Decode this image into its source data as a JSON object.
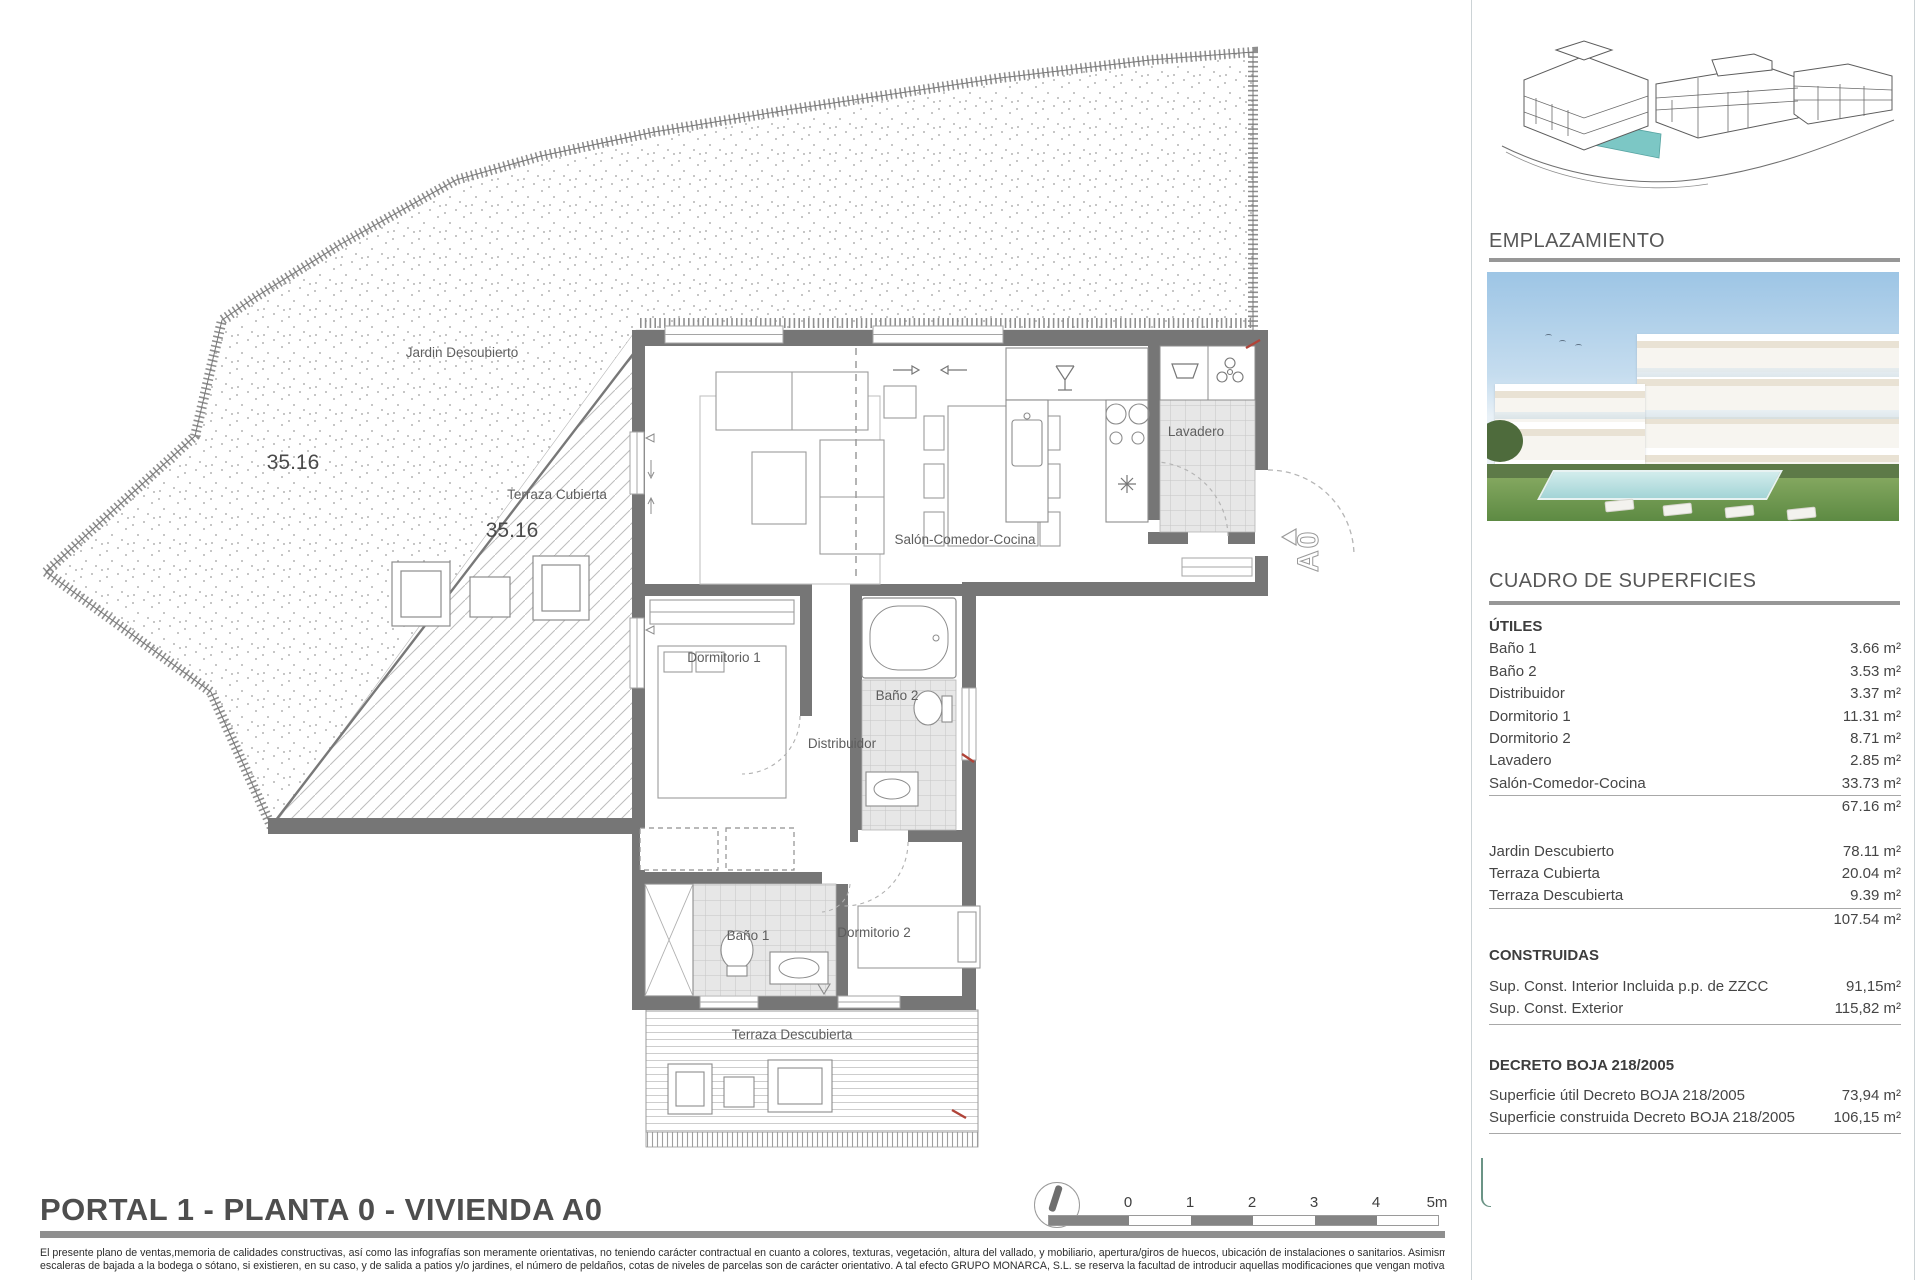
{
  "plan": {
    "title": "PORTAL 1 - PLANTA 0 - VIVIENDA A0",
    "labels": {
      "jardin": "Jardin Descubierto",
      "jardin_area": "35.16",
      "terraza_cubierta": "Terraza Cubierta",
      "terraza_cubierta_area": "35.16",
      "salon": "Salón-Comedor-Cocina",
      "lavadero": "Lavadero",
      "dormitorio1": "Dormitorio 1",
      "dormitorio2": "Dormitorio 2",
      "bano1": "Baño 1",
      "bano2": "Baño 2",
      "distribuidor": "Distribuidor",
      "terraza_descubierta": "Terraza Descubierta",
      "unit": "A0"
    },
    "scale": {
      "ticks": [
        "0",
        "1",
        "2",
        "3",
        "4",
        "5m"
      ]
    },
    "disclaimer": {
      "line1": "El presente plano de ventas,memoria de calidades constructivas, así como las infografías son meramente orientativas, no teniendo carácter contractual en cuanto a colores, texturas, vegetación, altura del vallado, y mobiliario, apertura/giros de huecos, ubicación de instalaciones o sanitarios. Asimismo, en las",
      "line2": "escaleras de bajada a la bodega o sótano, si existieren, en su caso, y de salida a patios y/o jardines, el número de peldaños, cotas de niveles de parcelas son de carácter orientativo. A tal efecto GRUPO MONARCA, S.L.  se reserva la facultad de introducir aquellas modificaciones que vengan motivadas por razones"
    }
  },
  "sidebar": {
    "emplazamiento_title": "EMPLAZAMIENTO",
    "cuadro_title": "CUADRO DE SUPERFICIES",
    "utiles": {
      "heading": "ÚTILES",
      "rows": [
        {
          "label": "Baño 1",
          "value": "3.66 m²"
        },
        {
          "label": "Baño 2",
          "value": "3.53 m²"
        },
        {
          "label": "Distribuidor",
          "value": "3.37 m²"
        },
        {
          "label": "Dormitorio 1",
          "value": "11.31 m²"
        },
        {
          "label": "Dormitorio 2",
          "value": "8.71 m²"
        },
        {
          "label": "Lavadero",
          "value": "2.85 m²"
        },
        {
          "label": "Salón-Comedor-Cocina",
          "value": "33.73 m²"
        }
      ],
      "total": "67.16 m²"
    },
    "exterior": {
      "rows": [
        {
          "label": "Jardin Descubierto",
          "value": "78.11 m²"
        },
        {
          "label": "Terraza Cubierta",
          "value": "20.04 m²"
        },
        {
          "label": "Terraza Descubierta",
          "value": "9.39 m²"
        }
      ],
      "total": "107.54 m²"
    },
    "construidas": {
      "heading": "CONSTRUIDAS",
      "rows": [
        {
          "label": "Sup. Const. Interior Incluida p.p. de ZZCC",
          "value": "91,15m²"
        },
        {
          "label": "Sup. Const. Exterior",
          "value": "115,82 m²"
        }
      ]
    },
    "decreto": {
      "heading": "DECRETO BOJA 218/2005",
      "rows": [
        {
          "label": "Superficie útil Decreto BOJA 218/2005",
          "value": "73,94 m²"
        },
        {
          "label": "Superficie construida Decreto BOJA 218/2005",
          "value": "106,15 m²"
        }
      ]
    }
  },
  "colors": {
    "wall": "#767676",
    "accent_teal": "#7cc7c5",
    "revision_red": "#b04338",
    "bar_gray": "#8f8f8f"
  }
}
